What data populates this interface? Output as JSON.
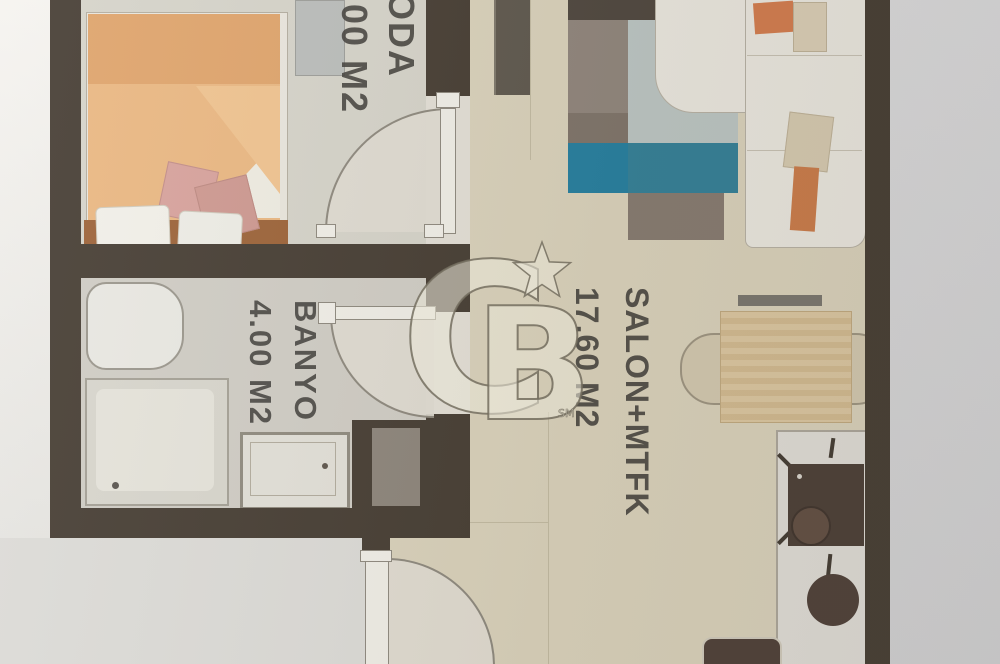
{
  "document": {
    "kind": "apartment floor plan photo"
  },
  "rooms": [
    {
      "name": "ODA",
      "area": ".00 M2"
    },
    {
      "name": "BANYO",
      "area": "4.00 M2"
    },
    {
      "name": "SALON+MTFK",
      "area": "17.60 M2"
    }
  ],
  "watermark": {
    "letter_c": "C",
    "letter_b": "B",
    "trademark": "SM",
    "star": "star-icon"
  },
  "colors": {
    "wall": "#41382e",
    "floor_beige": "#d9d1ba",
    "floor_gray": "#d5d3c9",
    "bathroom_floor": "#cfccc4",
    "rug_teal": "#2e7c95",
    "bed_orange": "#eab67f",
    "wood": "#9a5f33",
    "watermark_fill": "#f2edde"
  }
}
